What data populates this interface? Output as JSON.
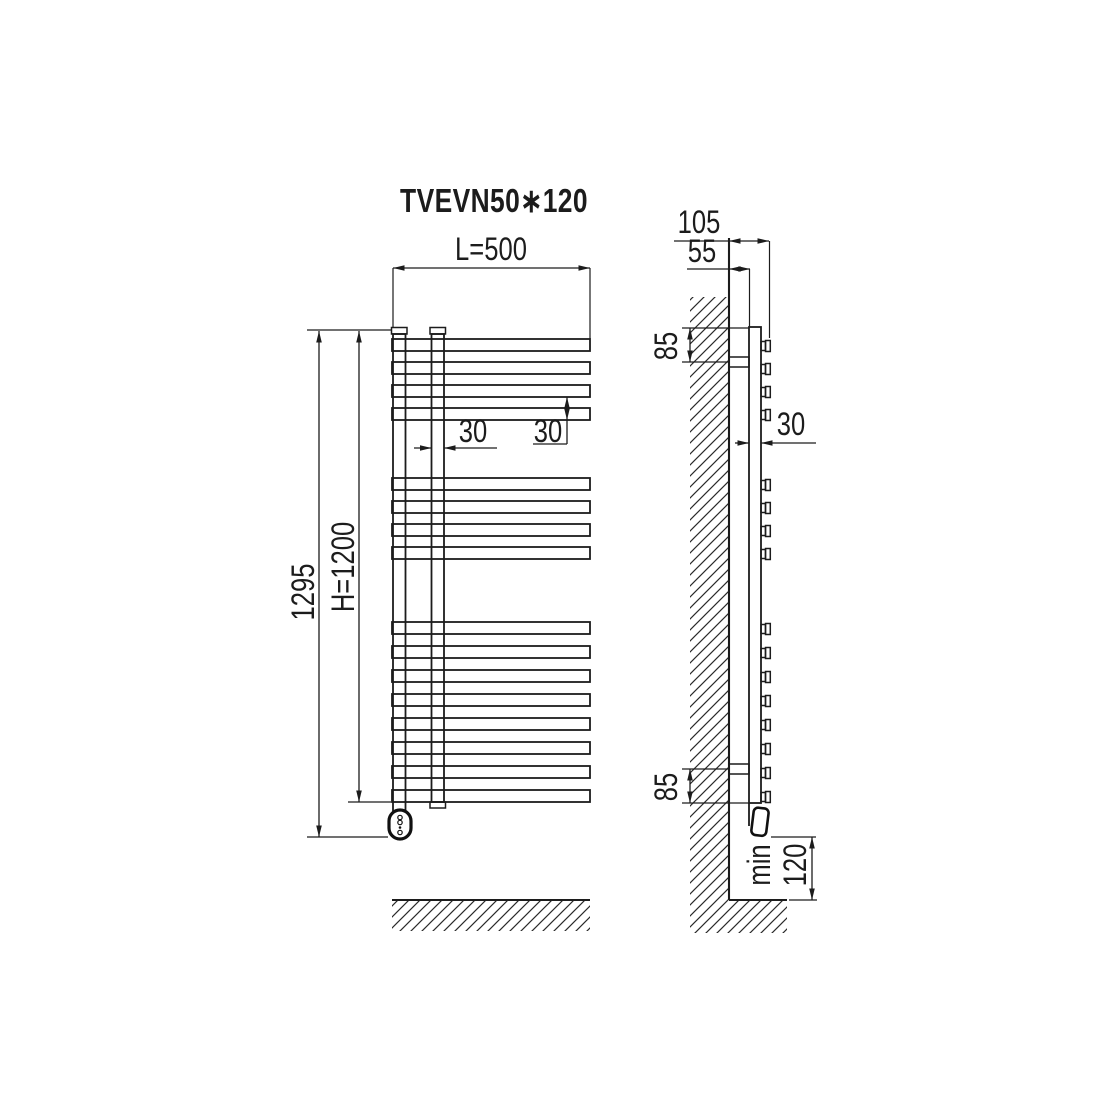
{
  "title": "TVEVN50∗120",
  "front_view": {
    "width_label": "L=500",
    "overall_height_label": "1295",
    "height_label": "H=1200",
    "collector_tube_width_label": "30",
    "bar_pitch_label": "30",
    "bar_groups": [
      4,
      4,
      8
    ],
    "bar_count": 16
  },
  "side_view": {
    "total_depth_label": "105",
    "wall_to_tube_label": "55",
    "top_bracket_offset_label": "85",
    "bottom_bracket_offset_label": "85",
    "tube_depth_label": "30",
    "floor_clearance_prefix_label": "min",
    "floor_clearance_value_label": "120"
  },
  "colors": {
    "line": "#1c1c1c",
    "background": "#ffffff"
  }
}
